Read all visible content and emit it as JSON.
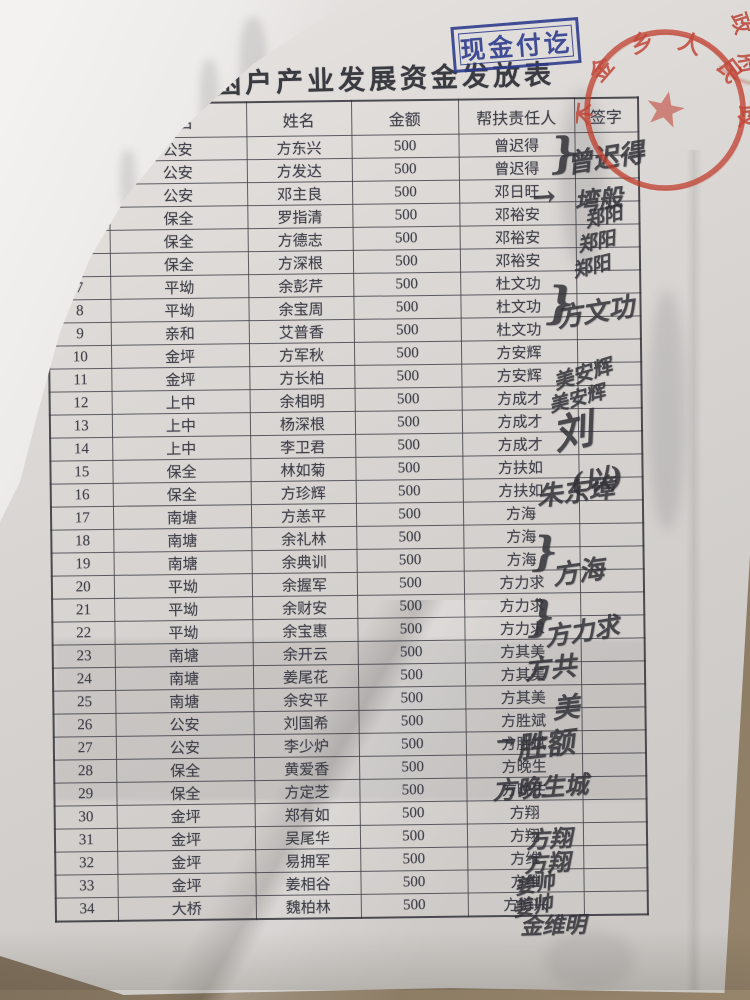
{
  "photo": {
    "surface_color": "#8a7a63",
    "paper_color": "#d9d6d3"
  },
  "stamp": {
    "text": "现金付讫",
    "color": "#2b3a8c"
  },
  "title": "木金乡贫困户产业发展资金发放表",
  "seal": {
    "arc_text": "木金乡人民政府",
    "corner_chars": [
      "政",
      "府"
    ],
    "color": "#bf3c2c"
  },
  "table": {
    "headers": [
      "号",
      "村名",
      "姓名",
      "金额",
      "帮扶责任人",
      "签字"
    ],
    "rows": [
      {
        "no": "1",
        "village": "公安",
        "name": "方东兴",
        "amount": "500",
        "helper": "曾迟得"
      },
      {
        "no": "2",
        "village": "公安",
        "name": "方发达",
        "amount": "500",
        "helper": "曾迟得"
      },
      {
        "no": "3",
        "village": "公安",
        "name": "邓主良",
        "amount": "500",
        "helper": "邓日旺"
      },
      {
        "no": "4",
        "village": "保全",
        "name": "罗指清",
        "amount": "500",
        "helper": "邓裕安"
      },
      {
        "no": "5",
        "village": "保全",
        "name": "方德志",
        "amount": "500",
        "helper": "邓裕安"
      },
      {
        "no": "6",
        "village": "保全",
        "name": "方深根",
        "amount": "500",
        "helper": "邓裕安"
      },
      {
        "no": "7",
        "village": "平坳",
        "name": "余彭芹",
        "amount": "500",
        "helper": "杜文功"
      },
      {
        "no": "8",
        "village": "平坳",
        "name": "余宝周",
        "amount": "500",
        "helper": "杜文功"
      },
      {
        "no": "9",
        "village": "亲和",
        "name": "艾普香",
        "amount": "500",
        "helper": "杜文功"
      },
      {
        "no": "10",
        "village": "金坪",
        "name": "方军秋",
        "amount": "500",
        "helper": "方安辉"
      },
      {
        "no": "11",
        "village": "金坪",
        "name": "方长柏",
        "amount": "500",
        "helper": "方安辉"
      },
      {
        "no": "12",
        "village": "上中",
        "name": "余相明",
        "amount": "500",
        "helper": "方成才"
      },
      {
        "no": "13",
        "village": "上中",
        "name": "杨深根",
        "amount": "500",
        "helper": "方成才"
      },
      {
        "no": "14",
        "village": "上中",
        "name": "李卫君",
        "amount": "500",
        "helper": "方成才"
      },
      {
        "no": "15",
        "village": "保全",
        "name": "林如菊",
        "amount": "500",
        "helper": "方扶如"
      },
      {
        "no": "16",
        "village": "保全",
        "name": "方珍辉",
        "amount": "500",
        "helper": "方扶如"
      },
      {
        "no": "17",
        "village": "南塘",
        "name": "方恙平",
        "amount": "500",
        "helper": "方海"
      },
      {
        "no": "18",
        "village": "南塘",
        "name": "余礼林",
        "amount": "500",
        "helper": "方海"
      },
      {
        "no": "19",
        "village": "南塘",
        "name": "余典训",
        "amount": "500",
        "helper": "方海"
      },
      {
        "no": "20",
        "village": "平坳",
        "name": "余握军",
        "amount": "500",
        "helper": "方力求"
      },
      {
        "no": "21",
        "village": "平坳",
        "name": "余财安",
        "amount": "500",
        "helper": "方力求"
      },
      {
        "no": "22",
        "village": "平坳",
        "name": "余宝惠",
        "amount": "500",
        "helper": "方力求"
      },
      {
        "no": "23",
        "village": "南塘",
        "name": "余开云",
        "amount": "500",
        "helper": "方其美"
      },
      {
        "no": "24",
        "village": "南塘",
        "name": "姜尾花",
        "amount": "500",
        "helper": "方其美"
      },
      {
        "no": "25",
        "village": "南塘",
        "name": "余安平",
        "amount": "500",
        "helper": "方其美"
      },
      {
        "no": "26",
        "village": "公安",
        "name": "刘国希",
        "amount": "500",
        "helper": "方胜斌"
      },
      {
        "no": "27",
        "village": "公安",
        "name": "李少炉",
        "amount": "500",
        "helper": "方胜斌"
      },
      {
        "no": "28",
        "village": "保全",
        "name": "黄爱香",
        "amount": "500",
        "helper": "方晚生"
      },
      {
        "no": "29",
        "village": "保全",
        "name": "方定芝",
        "amount": "500",
        "helper": "方晚生"
      },
      {
        "no": "30",
        "village": "金坪",
        "name": "郑有如",
        "amount": "500",
        "helper": "方翔"
      },
      {
        "no": "31",
        "village": "金坪",
        "name": "吴尾华",
        "amount": "500",
        "helper": "方翔"
      },
      {
        "no": "32",
        "village": "金坪",
        "name": "易拥军",
        "amount": "500",
        "helper": "方维"
      },
      {
        "no": "33",
        "village": "金坪",
        "name": "姜相谷",
        "amount": "500",
        "helper": "方维"
      },
      {
        "no": "34",
        "village": "大桥",
        "name": "魏柏林",
        "amount": "500",
        "helper": "方衍兴"
      }
    ]
  },
  "signatures": [
    {
      "text": "}",
      "x": 550,
      "y": 128,
      "size": 42,
      "rot": -5
    },
    {
      "text": "曾迟得",
      "x": 566,
      "y": 138,
      "size": 26,
      "rot": -9
    },
    {
      "text": "→",
      "x": 532,
      "y": 180,
      "size": 28,
      "rot": -4
    },
    {
      "text": "塆般",
      "x": 574,
      "y": 180,
      "size": 24,
      "rot": -6
    },
    {
      "text": "郑阳",
      "x": 584,
      "y": 202,
      "size": 19,
      "rot": -14
    },
    {
      "text": "郑阳",
      "x": 577,
      "y": 227,
      "size": 19,
      "rot": -12
    },
    {
      "text": "郑阳",
      "x": 572,
      "y": 252,
      "size": 19,
      "rot": -14
    },
    {
      "text": "}",
      "x": 546,
      "y": 278,
      "size": 44,
      "rot": 0
    },
    {
      "text": "方文功",
      "x": 556,
      "y": 292,
      "size": 26,
      "rot": -9
    },
    {
      "text": "美安辉",
      "x": 552,
      "y": 358,
      "size": 20,
      "rot": -17
    },
    {
      "text": "美安辉",
      "x": 548,
      "y": 384,
      "size": 19,
      "rot": -15
    },
    {
      "text": "刘",
      "x": 552,
      "y": 400,
      "size": 40,
      "rot": -12
    },
    {
      "text": "(以)",
      "x": 570,
      "y": 458,
      "size": 27,
      "rot": -9
    },
    {
      "text": "朱东璋",
      "x": 536,
      "y": 472,
      "size": 26,
      "rot": -7
    },
    {
      "text": "}",
      "x": 532,
      "y": 528,
      "size": 40,
      "rot": 0
    },
    {
      "text": "方海",
      "x": 552,
      "y": 552,
      "size": 26,
      "rot": -8
    },
    {
      "text": "}",
      "x": 528,
      "y": 592,
      "size": 42,
      "rot": 0
    },
    {
      "text": "方力求",
      "x": 544,
      "y": 612,
      "size": 25,
      "rot": -9
    },
    {
      "text": "方共",
      "x": 524,
      "y": 648,
      "size": 26,
      "rot": -6
    },
    {
      "text": "美",
      "x": 552,
      "y": 686,
      "size": 27,
      "rot": -6
    },
    {
      "text": "→",
      "x": 496,
      "y": 726,
      "size": 24,
      "rot": -2
    },
    {
      "text": "胜额",
      "x": 516,
      "y": 722,
      "size": 29,
      "rot": -7
    },
    {
      "text": "方晚生城",
      "x": 492,
      "y": 768,
      "size": 24,
      "rot": -4
    },
    {
      "text": "方翔",
      "x": 526,
      "y": 820,
      "size": 23,
      "rot": -3
    },
    {
      "text": "方翔",
      "x": 524,
      "y": 844,
      "size": 23,
      "rot": -3
    },
    {
      "text": "姜帅",
      "x": 514,
      "y": 868,
      "size": 20,
      "rot": -10
    },
    {
      "text": "姜帅",
      "x": 512,
      "y": 890,
      "size": 20,
      "rot": -10
    },
    {
      "text": "金维明",
      "x": 520,
      "y": 908,
      "size": 22,
      "rot": -2
    }
  ]
}
